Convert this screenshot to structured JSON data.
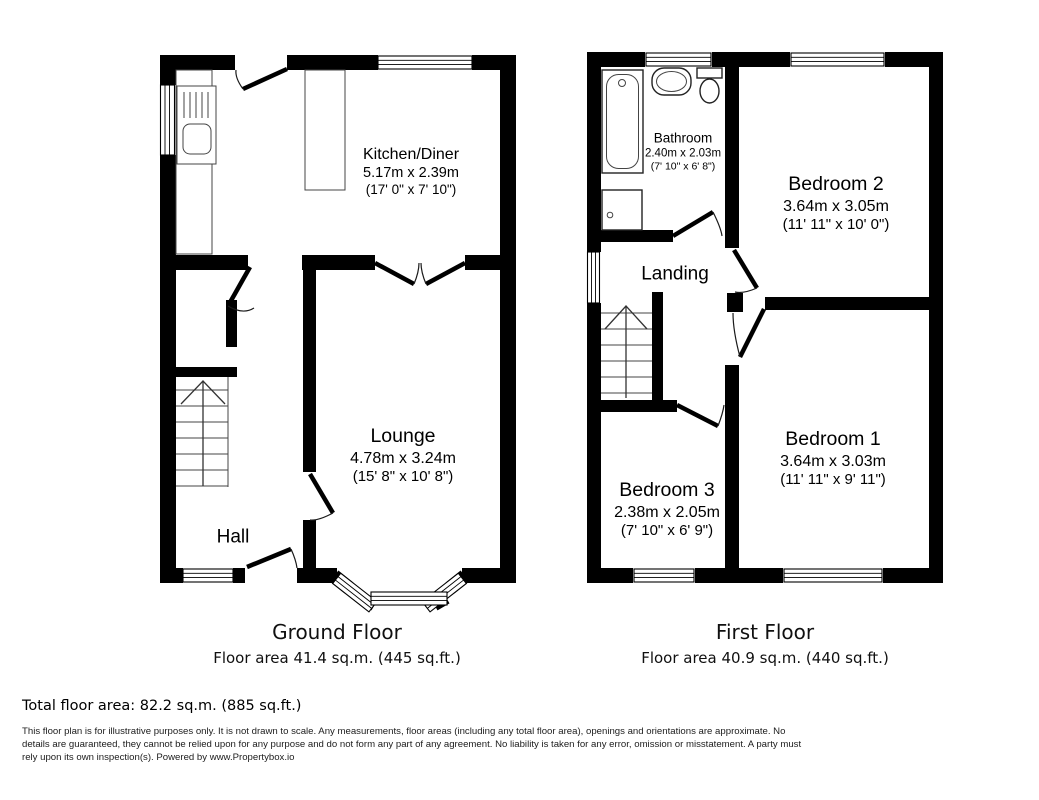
{
  "colors": {
    "wall": "#000000",
    "background": "#ffffff",
    "text": "#000000"
  },
  "ground_floor": {
    "title": "Ground Floor",
    "area_label": "Floor area 41.4 sq.m. (445 sq.ft.)",
    "rooms": {
      "kitchen": {
        "name": "Kitchen/Diner",
        "metric": "5.17m x 2.39m",
        "imperial": "(17' 0\" x 7' 10\")"
      },
      "lounge": {
        "name": "Lounge",
        "metric": "4.78m x 3.24m",
        "imperial": "(15' 8\" x 10' 8\")"
      },
      "hall": {
        "name": "Hall"
      }
    }
  },
  "first_floor": {
    "title": "First Floor",
    "area_label": "Floor area 40.9 sq.m. (440 sq.ft.)",
    "rooms": {
      "bathroom": {
        "name": "Bathroom",
        "metric": "2.40m x 2.03m",
        "imperial": "(7' 10\" x 6' 8\")"
      },
      "bedroom2": {
        "name": "Bedroom 2",
        "metric": "3.64m x 3.05m",
        "imperial": "(11' 11\" x 10' 0\")"
      },
      "landing": {
        "name": "Landing"
      },
      "bedroom1": {
        "name": "Bedroom 1",
        "metric": "3.64m x 3.03m",
        "imperial": "(11' 11\" x 9' 11\")"
      },
      "bedroom3": {
        "name": "Bedroom 3",
        "metric": "2.38m x 2.05m",
        "imperial": "(7' 10\" x 6' 9\")"
      }
    }
  },
  "summary": {
    "total_area": "Total floor area: 82.2 sq.m. (885 sq.ft.)"
  },
  "disclaimer": "This floor plan is for illustrative purposes only. It is not drawn to scale. Any measurements, floor areas (including any total floor area), openings and orientations are approximate. No details are guaranteed, they cannot be relied upon for any purpose and do not form any part of any agreement. No liability is taken for any error, omission or misstatement. A party must rely upon its own inspection(s). Powered by www.Propertybox.io"
}
